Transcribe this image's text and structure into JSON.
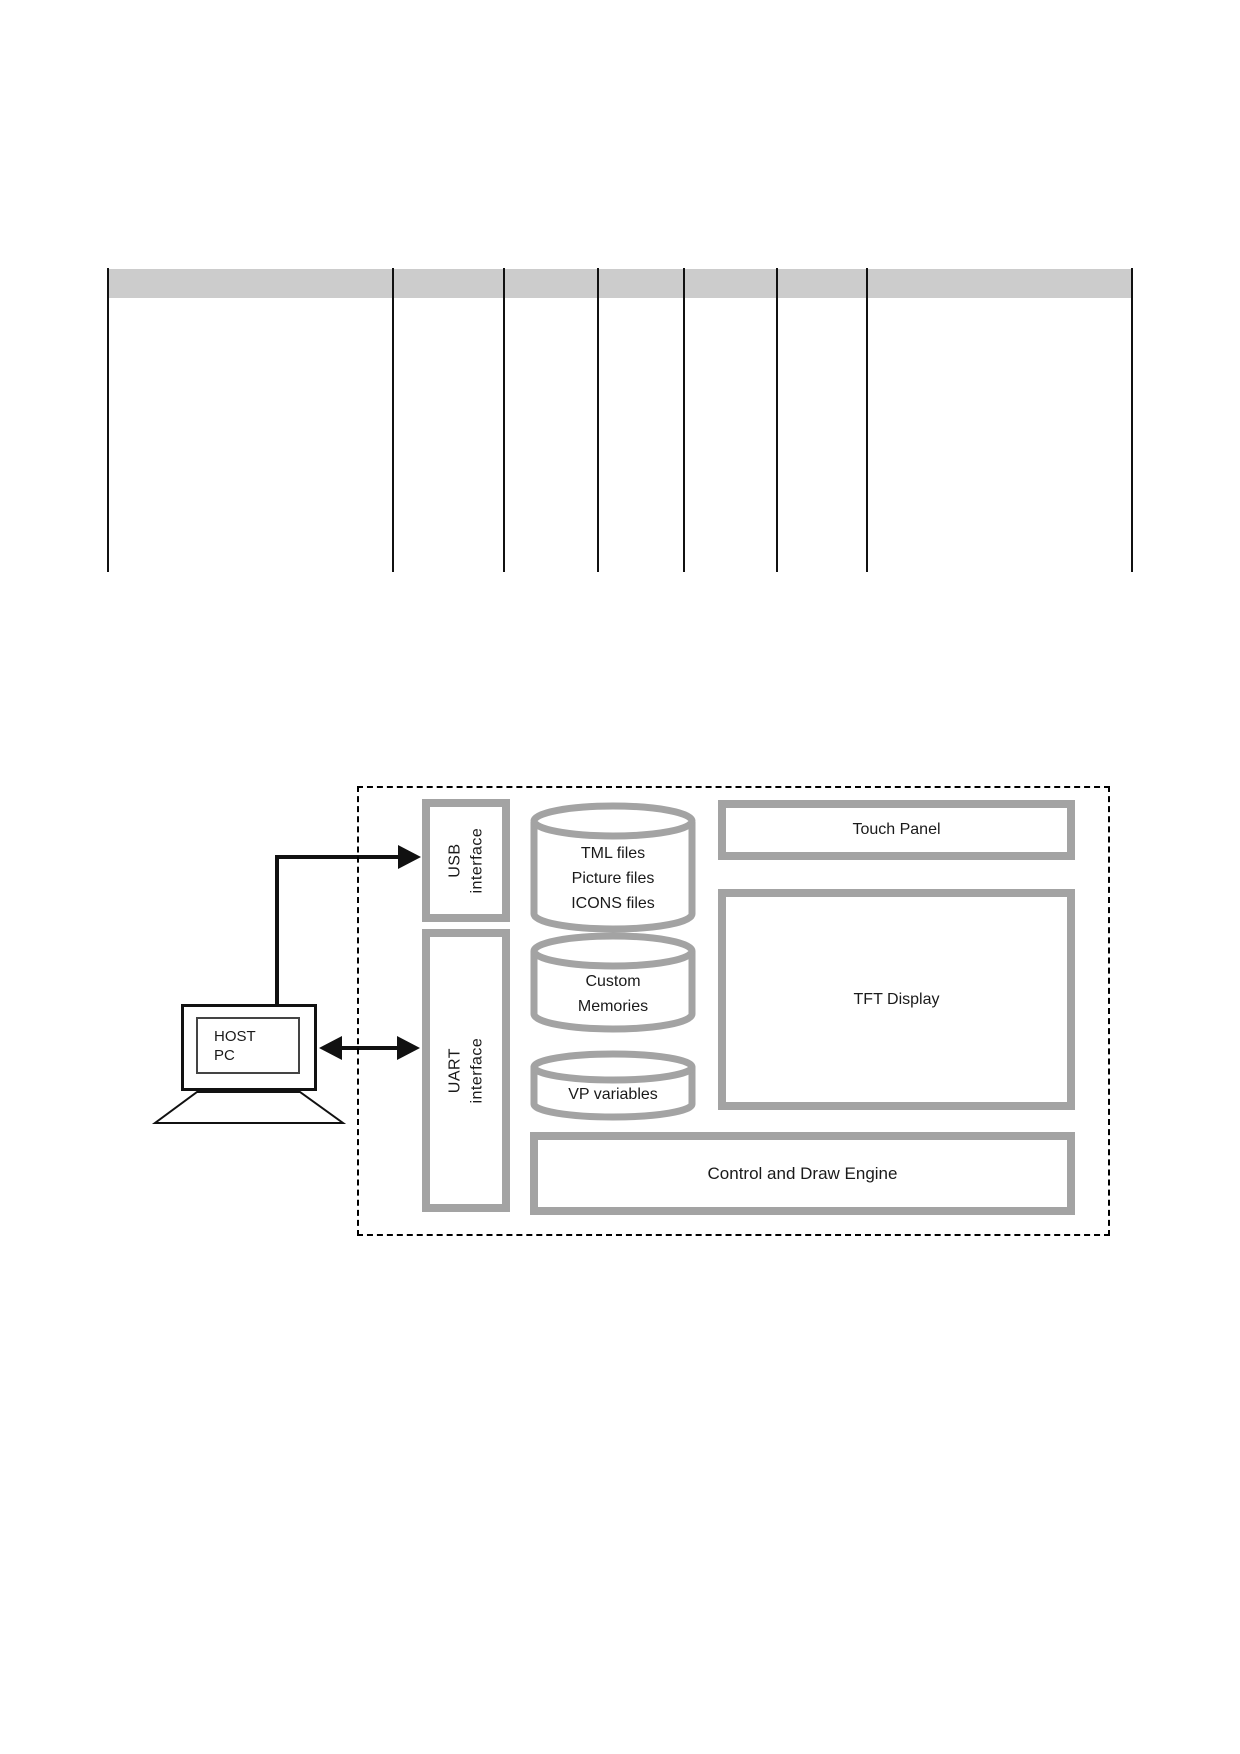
{
  "table": {
    "column_count": 7,
    "header_fill": "#cccccc"
  },
  "diagram": {
    "host_pc": {
      "line1": "HOST",
      "line2": "PC"
    },
    "usb_interface": {
      "line1": "USB",
      "line2": "interface"
    },
    "uart_interface": {
      "line1": "UART",
      "line2": "interface"
    },
    "cylinders": [
      {
        "lines": [
          "TML files",
          "Picture files",
          "ICONS files"
        ]
      },
      {
        "lines": [
          "Custom",
          "Memories"
        ]
      },
      {
        "lines": [
          "VP variables"
        ]
      }
    ],
    "touch_panel_label": "Touch Panel",
    "tft_display_label": "TFT Display",
    "control_draw_engine_label": "Control and Draw Engine",
    "colors": {
      "box_border": "#a3a3a3",
      "table_header": "#cccccc",
      "line": "#111111",
      "text": "#1a1a1a"
    }
  }
}
